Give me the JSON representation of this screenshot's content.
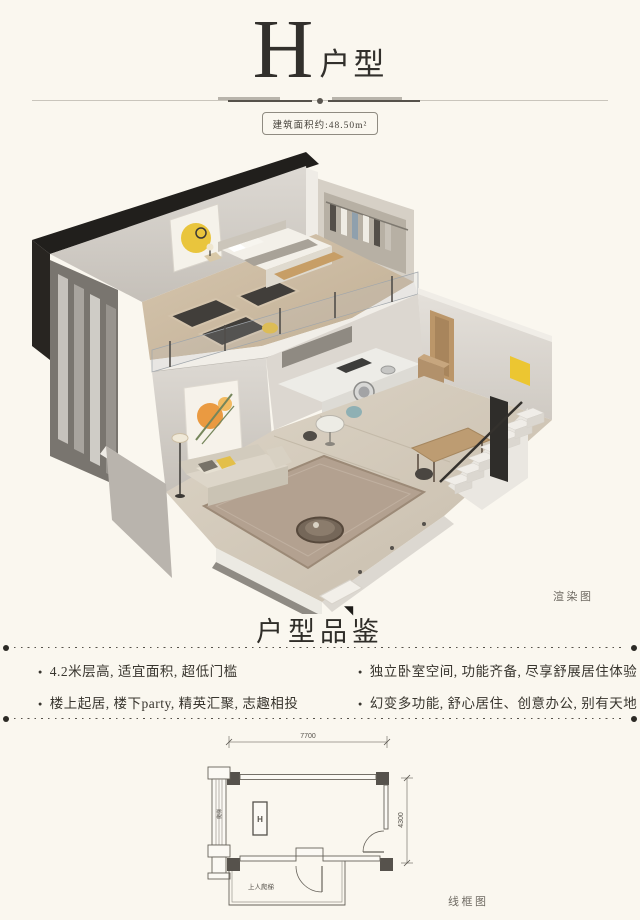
{
  "page": {
    "background": "#faf7ef",
    "ink": "#35322c",
    "muted": "#6f6b63"
  },
  "header": {
    "title_letter": "H",
    "title_suffix": "户型",
    "area_badge": "建筑面积约:48.50m²"
  },
  "render_figure": {
    "label": "渲染图",
    "palette": {
      "cut_wall": "#211f1c",
      "wall": "#d6d1ca",
      "floor": "#d3c9b8",
      "accent_yellow": "#e9c53d",
      "accent_orange": "#ea9a41",
      "stair_rail": "#2f2d2a"
    }
  },
  "appreciation": {
    "heading": "户型品鉴",
    "heading_accent": "◥",
    "bullet_glyph": "●",
    "bullets_left": [
      "4.2米层高, 适宜面积, 超低门槛",
      "楼上起居, 楼下party, 精英汇聚, 志趣相投"
    ],
    "bullets_right": [
      "独立卧室空间, 功能齐备, 尽享舒展居住体验",
      "幻变多功能, 舒心居住、创意办公, 别有天地"
    ]
  },
  "wireframe": {
    "label": "线框图",
    "dim_top": "7700",
    "dim_right": "4300",
    "unit_marker": "H",
    "annotation": "上人爬梯",
    "ladder_label": "爬梯"
  }
}
